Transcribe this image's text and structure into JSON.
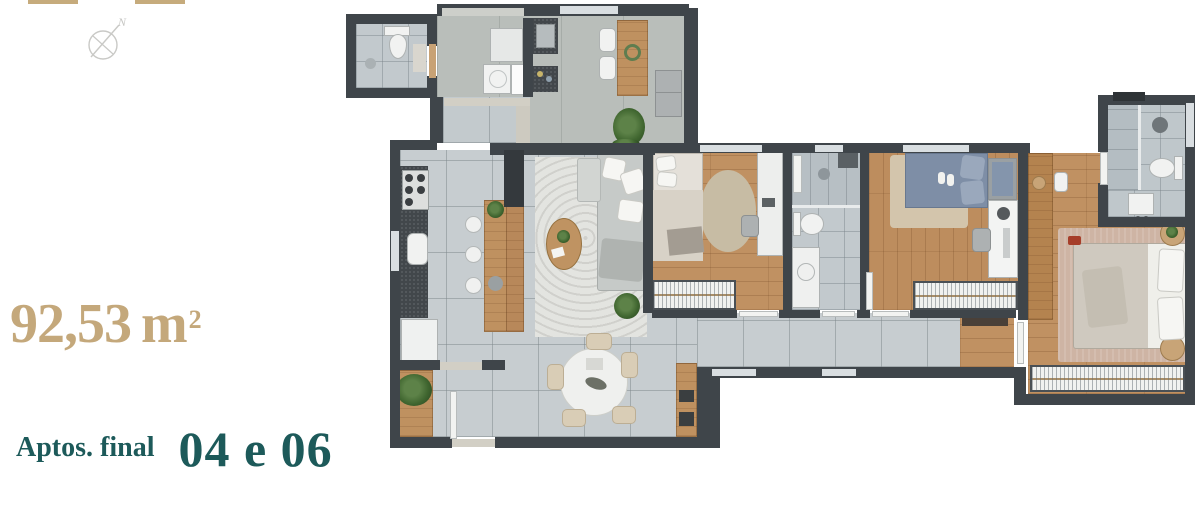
{
  "legend": {
    "area": {
      "value": "92,53",
      "unit": "m",
      "sup": "2",
      "color": "#c4a87b"
    },
    "apartments": {
      "prefix": "Aptos. final",
      "numbers": "04 e 06",
      "color": "#1d5a5a"
    },
    "compass": {
      "label": "N"
    }
  },
  "plan": {
    "type": "apartment-floor-plan",
    "colors": {
      "walls": "#3f454a",
      "floor_tile": "#c7cdd0",
      "bath_tile": "#c2c9cd",
      "wood_floor": "#c09162",
      "service_concrete": "#b9beba",
      "accent_tan": "#c4a87b",
      "accent_teal": "#1d5a5a",
      "bedding_blue": "#7e8ea6",
      "bedding_beige": "#d8d2c7",
      "rug_living": "#e3e4e0",
      "rug_master": "#ceb4a4",
      "fixtures_white": "#f1f2f1",
      "counter_dark": "#42474b",
      "plant_green": "#3f652f"
    }
  }
}
